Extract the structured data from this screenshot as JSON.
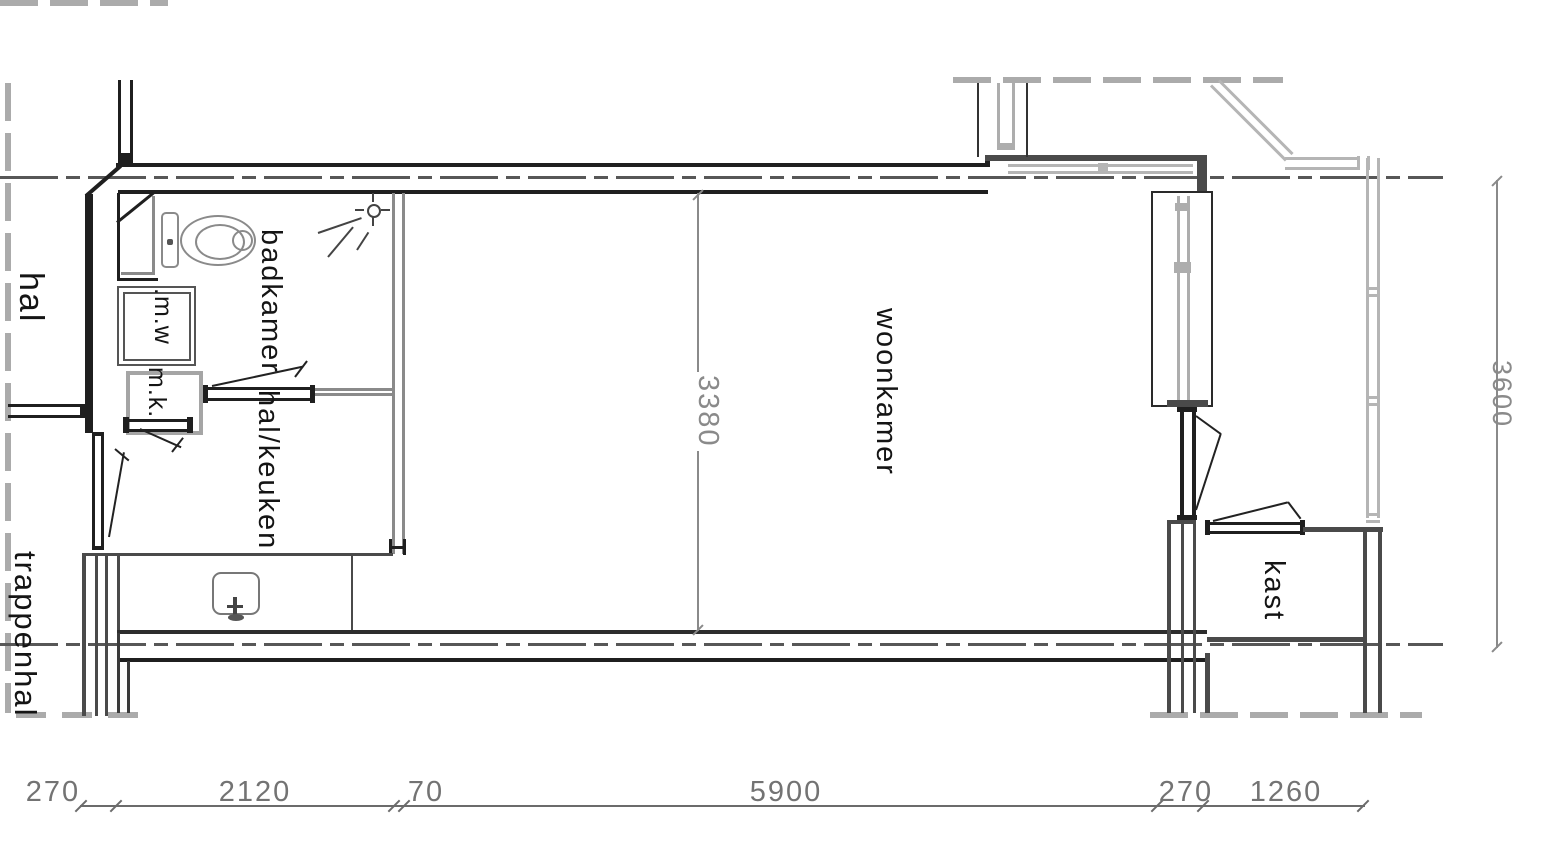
{
  "rooms": {
    "hal": "hal",
    "badkamer": "badkamer",
    "hal_keuken": "hal/keuken",
    "woonkamer": "woonkamer",
    "kast": "kast",
    "trappenhal": "trappenhal"
  },
  "fixtures": {
    "washing_machine": ".m.w",
    "meter_closet": "m.k."
  },
  "dimensions": {
    "bottom": [
      "270",
      "2120",
      "70",
      "5900",
      "270",
      "1260"
    ],
    "interior_width": "3380",
    "right_height": "3600"
  },
  "colors": {
    "wall_black": "#1f1f1f",
    "wall_dark_gray": "#4a4a4a",
    "partition_gray": "#8a8a8a",
    "light_gray": "#adadad",
    "dimension_gray": "#737373"
  }
}
